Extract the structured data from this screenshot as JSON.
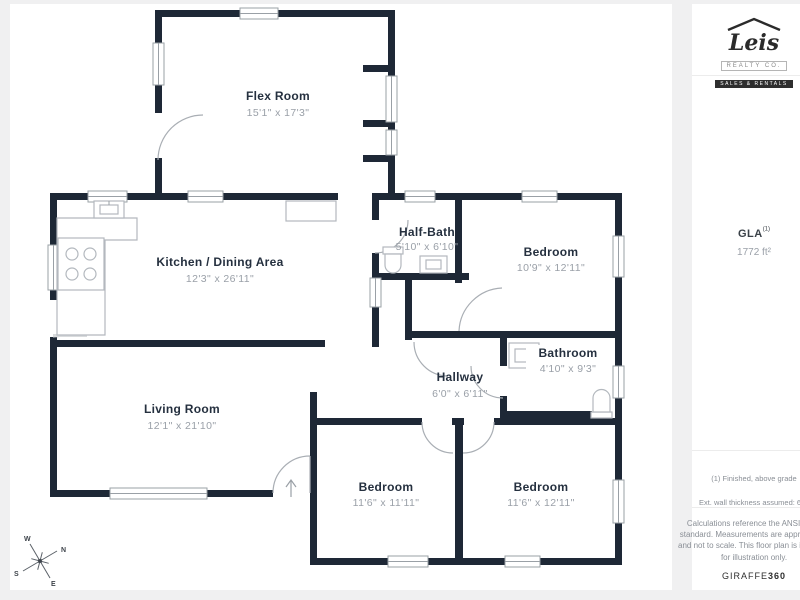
{
  "floor_plan": {
    "rooms": [
      {
        "name": "Flex Room",
        "dims": "15'1\" x 17'3\""
      },
      {
        "name": "Kitchen / Dining Area",
        "dims": "12'3\" x 26'11\""
      },
      {
        "name": "Half-Bath",
        "dims": "5'10\" x 6'10\""
      },
      {
        "name": "Bedroom",
        "dims": "10'9\" x 12'11\""
      },
      {
        "name": "Bathroom",
        "dims": "4'10\" x 9'3\""
      },
      {
        "name": "Hallway",
        "dims": "6'0\" x 6'11\""
      },
      {
        "name": "Living Room",
        "dims": "12'1\" x 21'10\""
      },
      {
        "name": "Bedroom",
        "dims": "11'6\" x 11'11\""
      },
      {
        "name": "Bedroom",
        "dims": "11'6\" x 12'11\""
      }
    ],
    "compass": {
      "n": "N",
      "e": "E",
      "s": "S",
      "w": "W"
    },
    "colors": {
      "wall": "#1e2836",
      "label": "#25303f",
      "dims": "#9aa0a8",
      "background": "#f0f0f1"
    }
  },
  "sidebar": {
    "logo": {
      "name": "Leis",
      "subtitle": "REALTY CO.",
      "tagline": "SALES & RENTALS"
    },
    "gla": {
      "label": "GLA",
      "sup": "(1)",
      "value": "1772 ft²"
    },
    "notes": [
      "(1) Finished, above grade",
      "Ext. wall thickness assumed: 6 in"
    ],
    "disclaimer": "Calculations reference the ANSI-Z765 standard. Measurements are approximate and not to scale. This floor plan is intended for illustration only.",
    "brand": {
      "name": "GIRAFFE",
      "bold": "360"
    }
  }
}
